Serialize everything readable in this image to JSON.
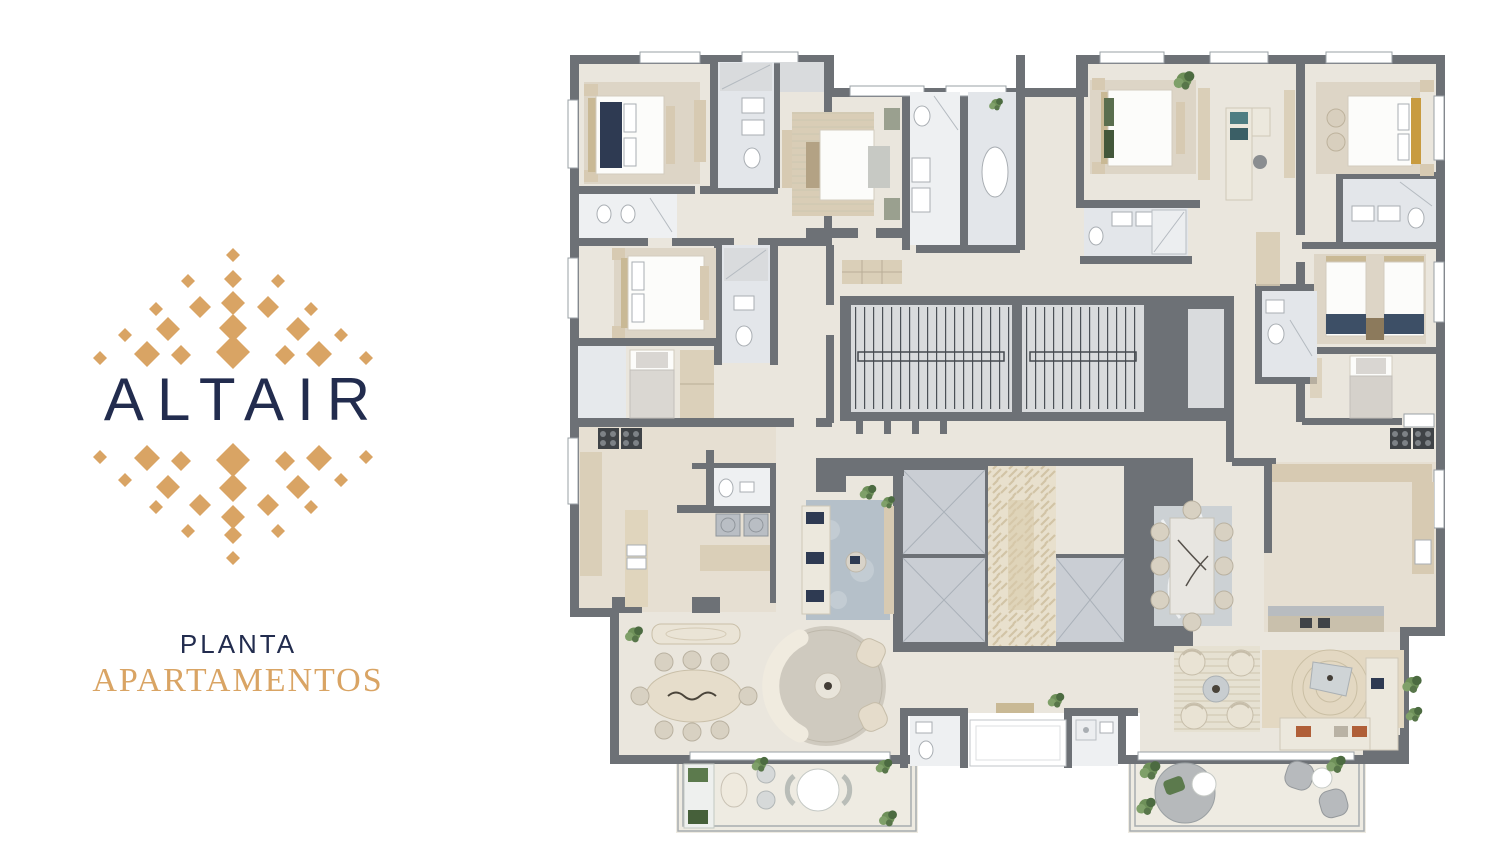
{
  "brand": {
    "name": "ALTAIR",
    "tagline_line1": "PLANTA",
    "tagline_line2": "APARTAMENTOS"
  },
  "colors": {
    "brand-navy": "#222c4e",
    "brand-gold": "#d9a464",
    "plan-wall": "#6d7176",
    "plan-floor": "#eae6dd",
    "plan-floor-warm": "#e6dfd2",
    "plan-bath": "#e3e6ea",
    "plan-marble": "#eef0f2",
    "plan-wood": "#d7cab2",
    "plan-stair": "#d9dbdd",
    "plan-elevator": "#caced4",
    "plan-tile": "#e8e0cd",
    "plan-rug-blue": "#b5c0c9",
    "plan-plant": "#6e9059",
    "plan-bed-navy": "#2e3a52",
    "plan-bed-gold": "#c89b3f",
    "plan-terracotta": "#b05f38",
    "background": "#ffffff"
  }
}
